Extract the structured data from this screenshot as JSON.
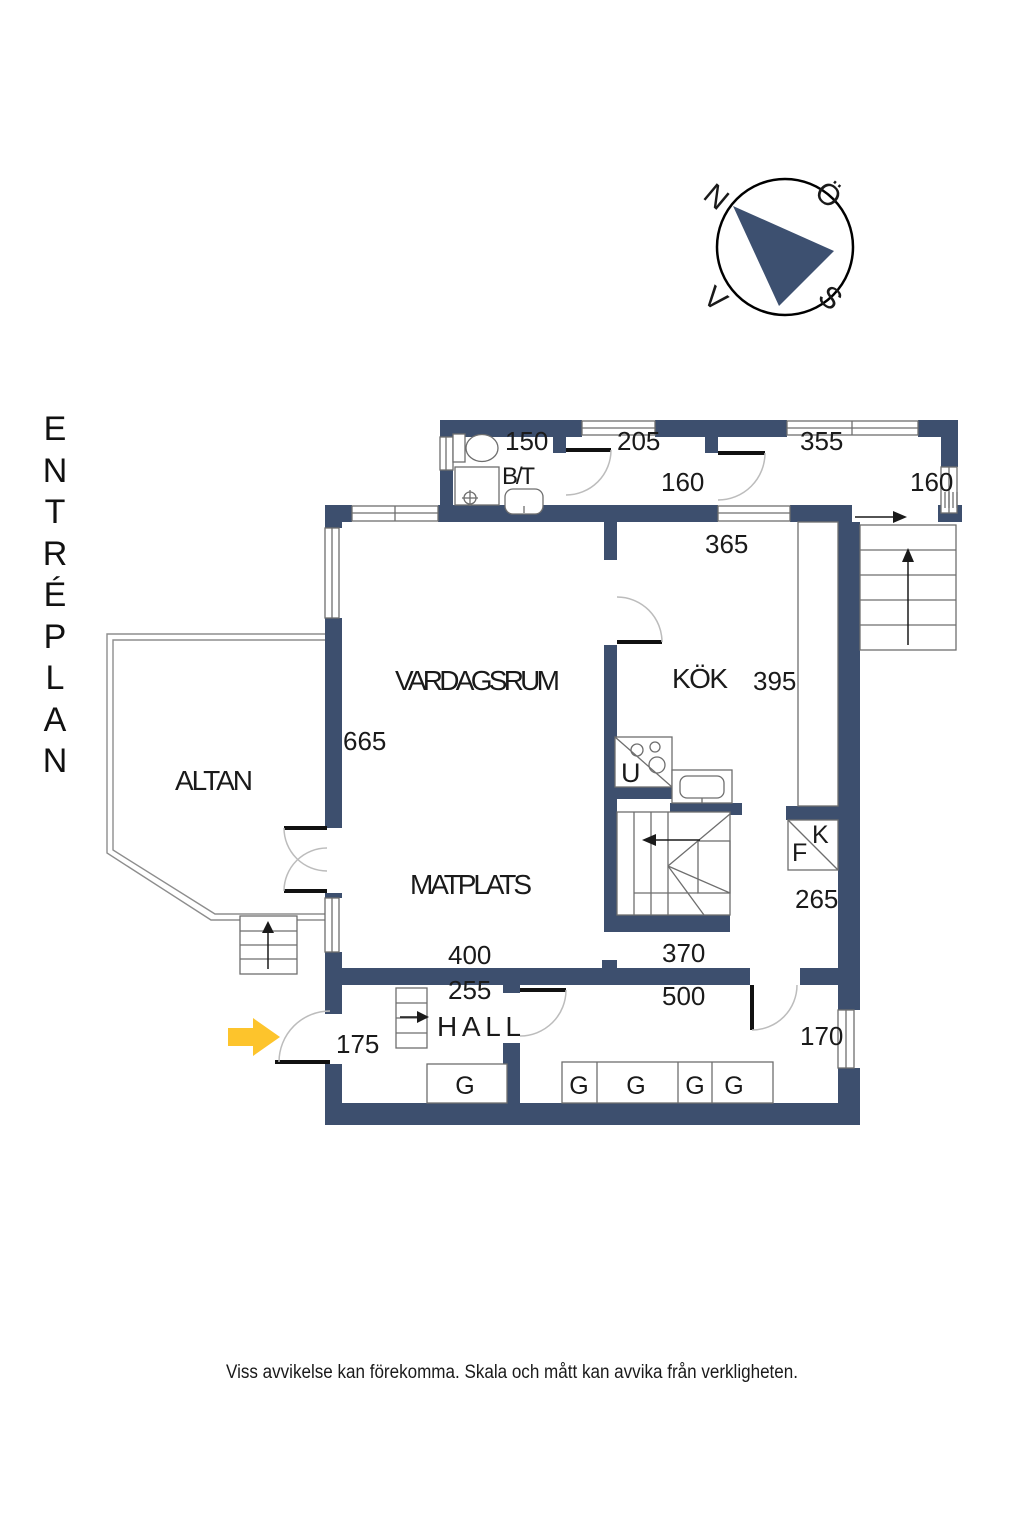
{
  "page": {
    "title": "ENTRÉPLAN",
    "title_letters": [
      "E",
      "N",
      "T",
      "R",
      "É",
      "P",
      "L",
      "A",
      "N"
    ],
    "disclaimer": "Viss avvikelse kan förekomma. Skala och mått kan avvika från verkligheten."
  },
  "compass": {
    "north": "N",
    "east": "Ö",
    "south": "S",
    "west": "V"
  },
  "rooms": {
    "vardagsrum": "VARDAGSRUM",
    "kok": "KÖK",
    "matplats": "MATPLATS",
    "altan": "ALTAN",
    "hall": "HALL",
    "badrum": "B/T"
  },
  "fixtures": {
    "oven": "U",
    "fridge": "K",
    "freezer": "F",
    "wardrobe": "G"
  },
  "dimensions": {
    "badrum_bredd": "150",
    "passage_bredd": "205",
    "farstu_bredd": "355",
    "passage_djup": "160",
    "farstu_djup": "160",
    "kok_bredd": "365",
    "kok_langd": "395",
    "vardagsrum_langd": "665",
    "korridor_djup": "265",
    "matplats_bredd": "400",
    "oppning_bredd": "370",
    "hall_bredd": "255",
    "allrum_bredd": "500",
    "entre_bredd": "175",
    "allrum_djup": "170"
  },
  "colors": {
    "wall": "#3d4f6e",
    "arrow": "#fdc42c",
    "needle": "#3d5070"
  }
}
